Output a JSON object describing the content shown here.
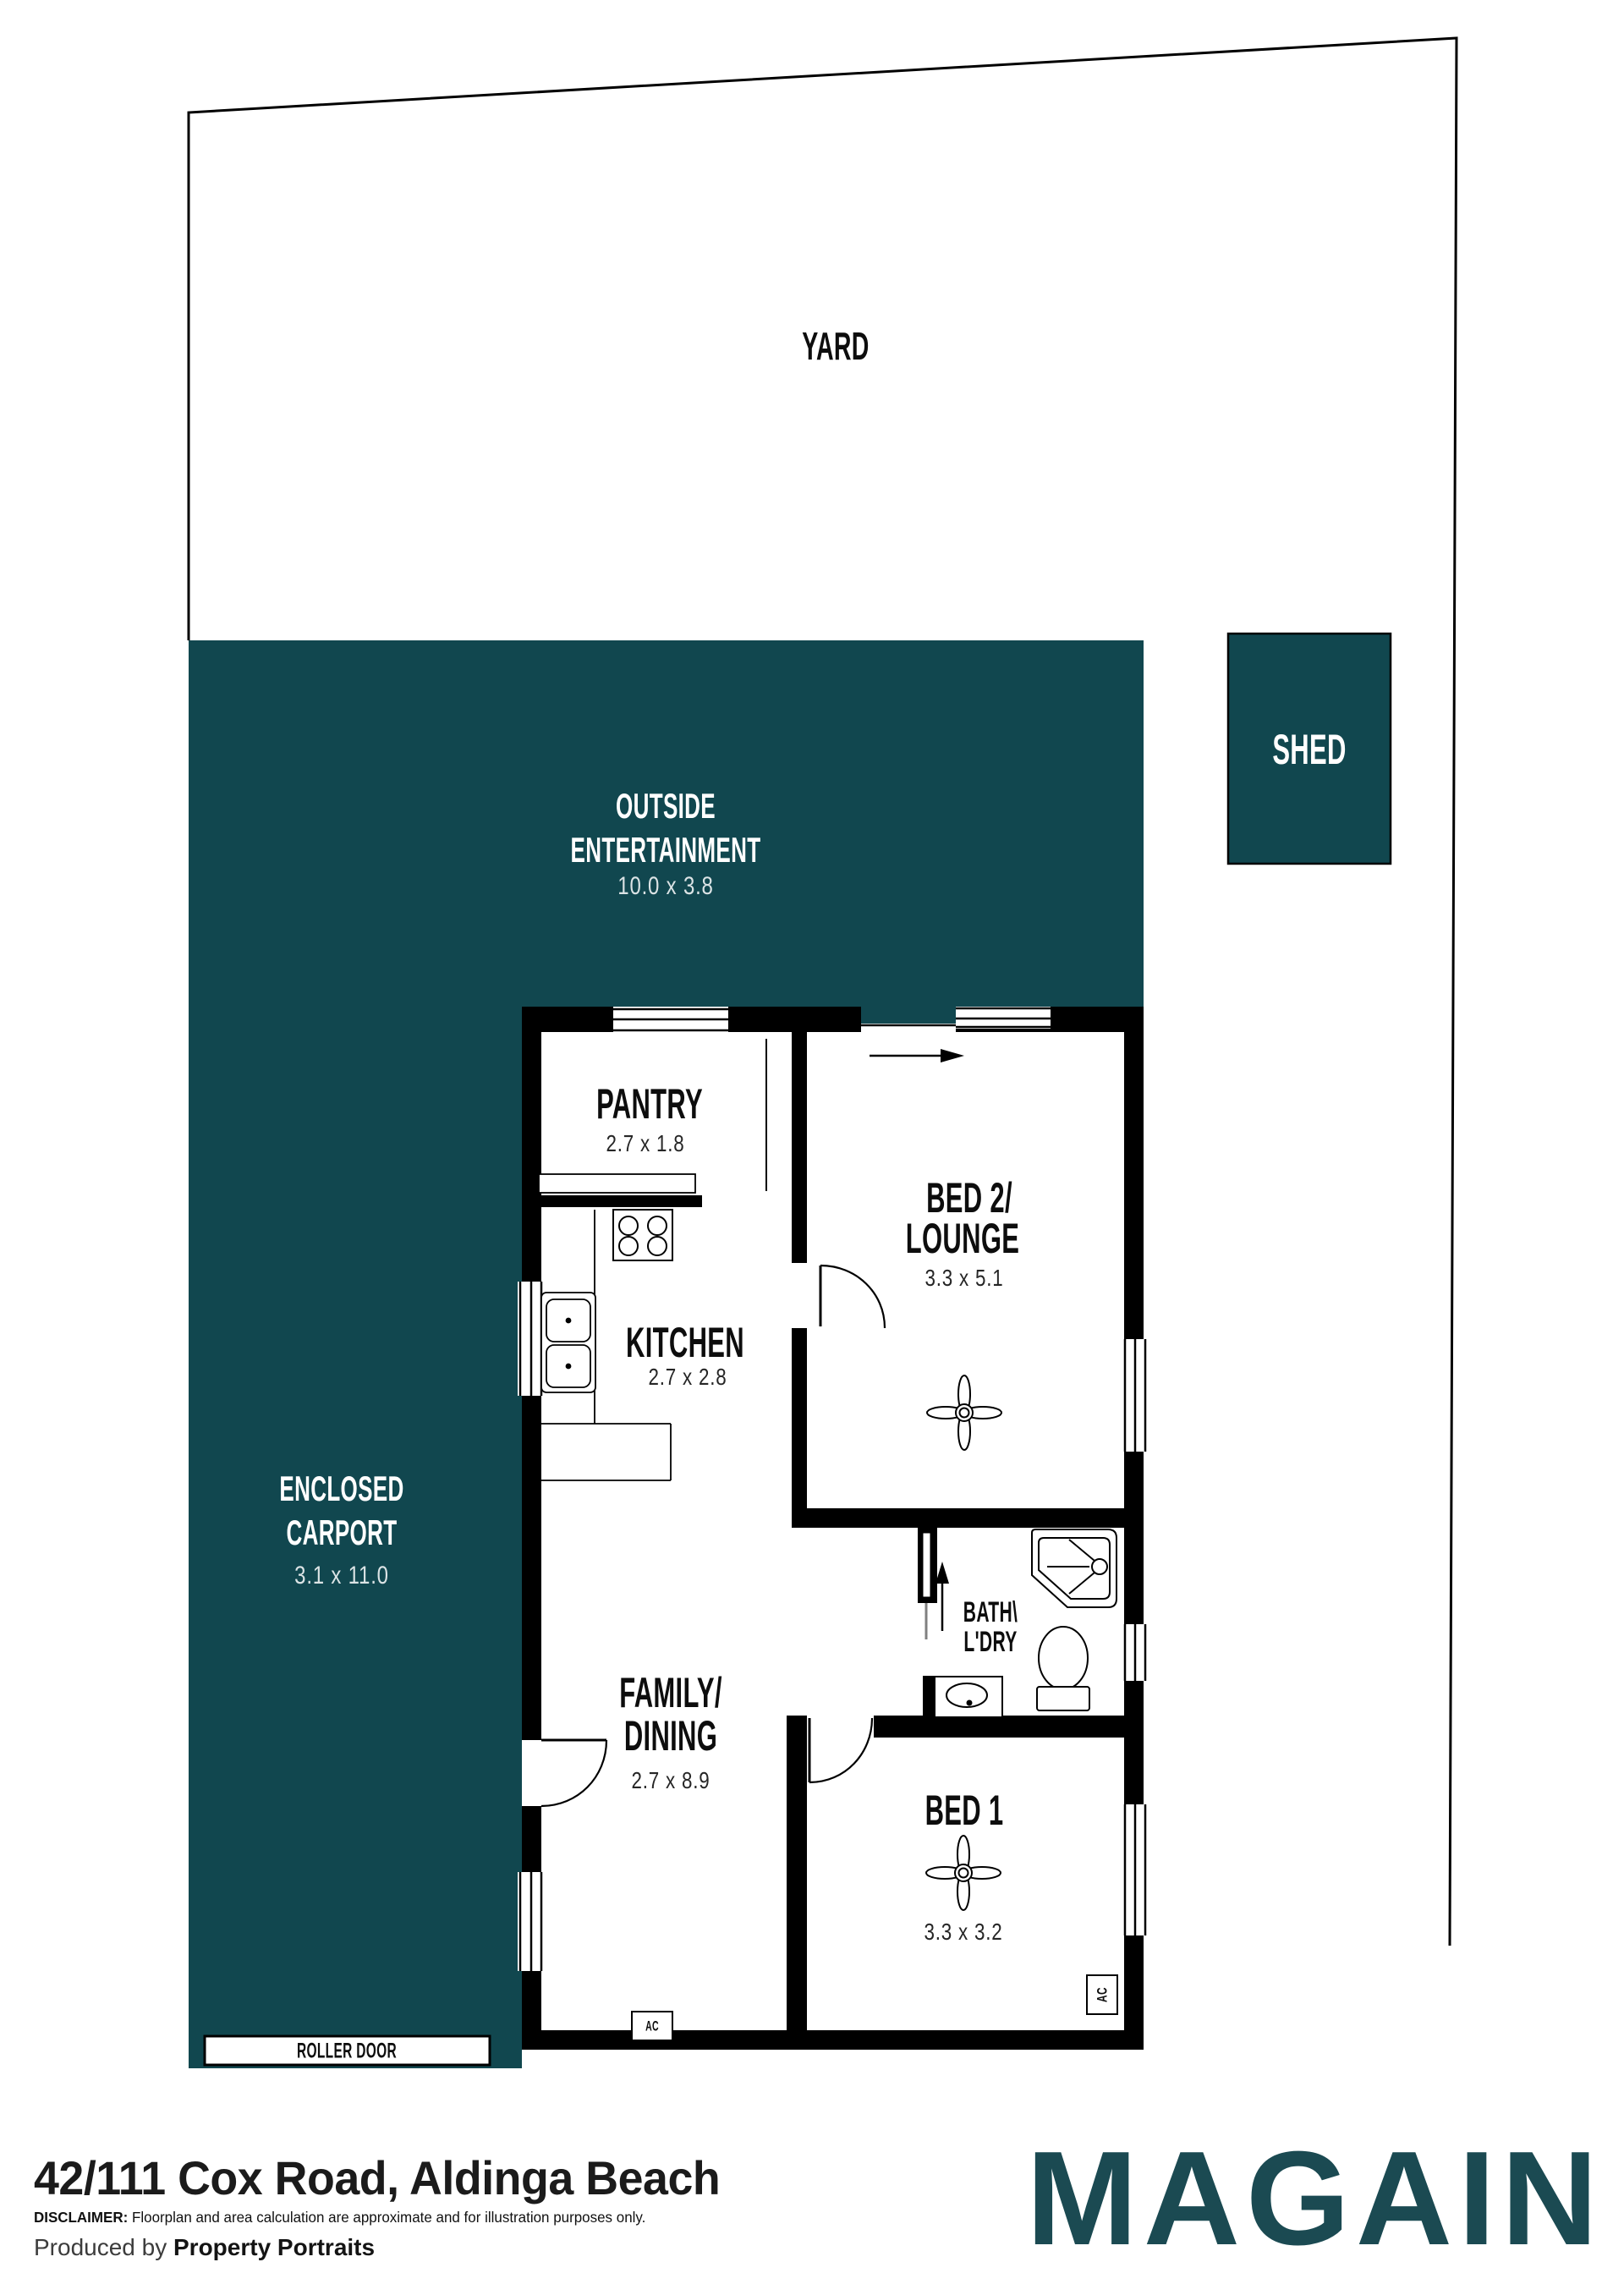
{
  "colors": {
    "teal": "#11474f",
    "logo_teal": "#1b4a52",
    "wall": "#000000"
  },
  "yard": {
    "label": "YARD"
  },
  "shed": {
    "label": "SHED"
  },
  "outside_entertainment": {
    "line1": "OUTSIDE",
    "line2": "ENTERTAINMENT",
    "dims": "10.0 x 3.8"
  },
  "carport": {
    "line1": "ENCLOSED",
    "line2": "CARPORT",
    "dims": "3.1 x 11.0",
    "roller_door": "ROLLER DOOR"
  },
  "rooms": {
    "pantry": {
      "name": "PANTRY",
      "dims": "2.7 x 1.8"
    },
    "kitchen": {
      "name": "KITCHEN",
      "dims": "2.7 x 2.8"
    },
    "bed2": {
      "line1": "BED 2/",
      "line2": "LOUNGE",
      "dims": "3.3 x 5.1"
    },
    "family": {
      "line1": "FAMILY/",
      "line2": "DINING",
      "dims": "2.7 x 8.9"
    },
    "bath": {
      "line1": "BATH\\",
      "line2": "L'DRY"
    },
    "bed1": {
      "name": "BED 1",
      "dims": "3.3 x 3.2"
    }
  },
  "labels": {
    "ac": "AC"
  },
  "footer": {
    "address": "42/111 Cox Road, Aldinga Beach",
    "disclaimer_prefix": "DISCLAIMER:",
    "disclaimer_text": " Floorplan and area calculation are approximate and for illustration purposes only.",
    "produced_prefix": "Produced by ",
    "produced_brand": "Property Portraits",
    "logo": "MAGAIN"
  }
}
